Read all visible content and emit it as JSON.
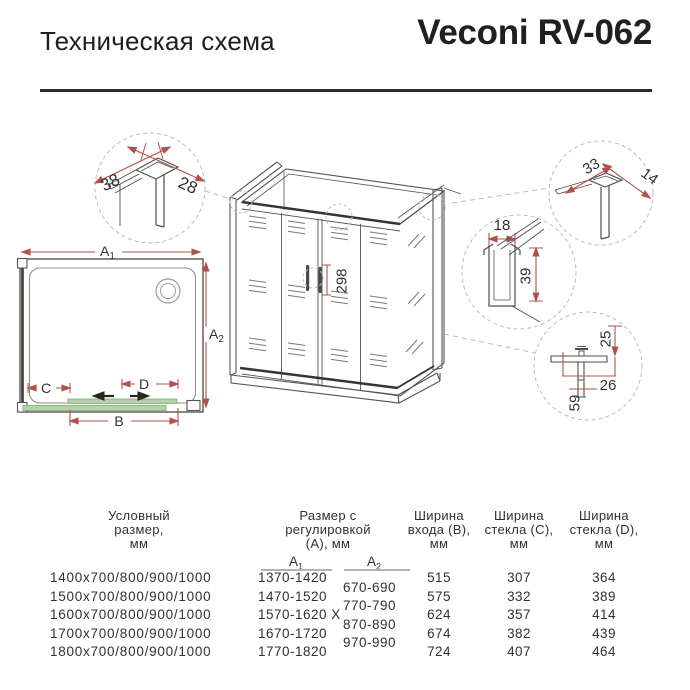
{
  "header": {
    "title_left": "Техническая схема",
    "title_right": "Veconi RV-062"
  },
  "diagram": {
    "dims": {
      "d38": "38",
      "d28": "28",
      "d33": "33",
      "d14": "14",
      "d18": "18",
      "d39": "39",
      "d25": "25",
      "d26": "26",
      "d59": "59",
      "d298": "298"
    },
    "labels": {
      "a1_base": "A",
      "a1_sub": "1",
      "a2_base": "A",
      "a2_sub": "2",
      "b": "B",
      "c": "C",
      "d": "D"
    },
    "colors": {
      "dimension_red": "#b0524b",
      "glass_green": "#b3d2aa",
      "ink": "#32312c",
      "line": "#55544f"
    }
  },
  "table": {
    "headers": {
      "size": "Условный\nразмер,\nмм",
      "adjust": "Размер с\nрегулировкой\n(А), мм",
      "entry_width": "Ширина\nвхода (B),\nмм",
      "glass_c": "Ширина\nстекла (C),\nмм",
      "glass_d": "Ширина\nстекла (D),\nмм"
    },
    "sub_a1": {
      "base": "A",
      "sub": "1"
    },
    "sub_a2": {
      "base": "A",
      "sub": "2"
    },
    "rows": [
      {
        "size": "1400x700/800/900/1000",
        "a1": "1370-1420",
        "b": "515",
        "c": "307",
        "d": "364"
      },
      {
        "size": "1500x700/800/900/1000",
        "a1": "1470-1520",
        "b": "575",
        "c": "332",
        "d": "389"
      },
      {
        "size": "1600x700/800/900/1000",
        "a1": "1570-1620 X",
        "b": "624",
        "c": "357",
        "d": "414"
      },
      {
        "size": "1700x700/800/900/1000",
        "a1": "1670-1720",
        "b": "674",
        "c": "382",
        "d": "439"
      },
      {
        "size": "1800x700/800/900/1000",
        "a1": "1770-1820",
        "b": "724",
        "c": "407",
        "d": "464"
      }
    ],
    "a2_values": [
      "670-690",
      "770-790",
      "870-890",
      "970-990"
    ]
  }
}
